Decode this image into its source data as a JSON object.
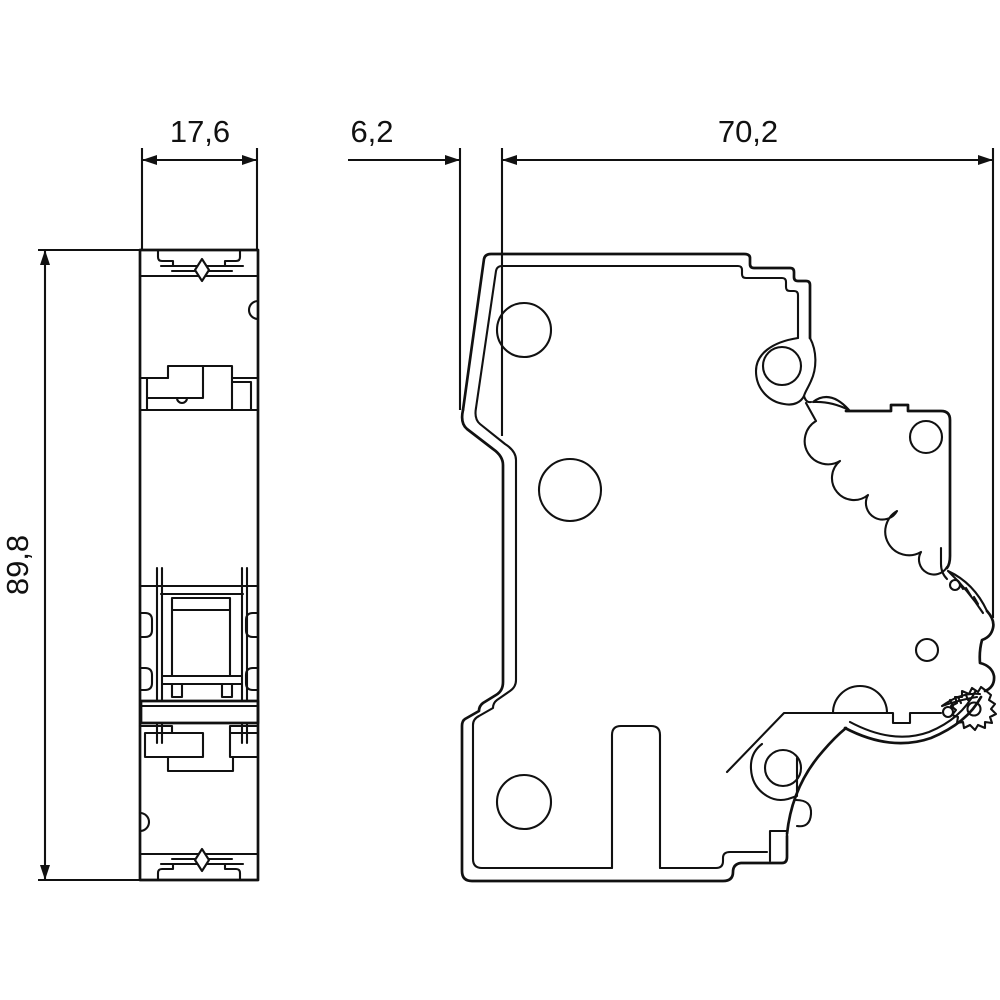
{
  "drawing": {
    "background": "#ffffff",
    "line_color": "#111111",
    "views": {
      "front_view": "front-view-of-din-module",
      "side_view": "side-view-of-din-module"
    },
    "dimensions": {
      "front_width_mm": "17,6",
      "handle_depth_mm": "6,2",
      "body_depth_mm": "70,2",
      "height_mm": "89,8"
    }
  }
}
